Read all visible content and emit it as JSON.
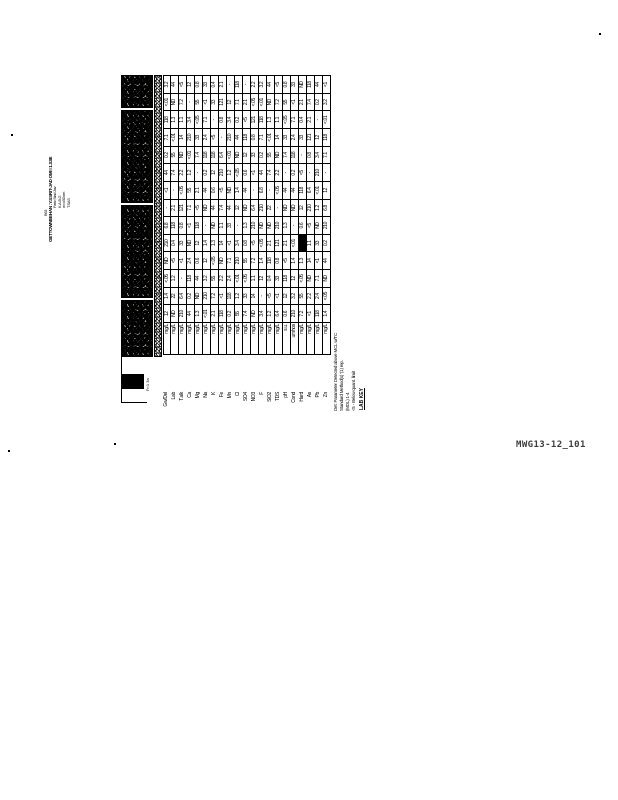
{
  "page": {
    "kind": "scanned-document",
    "figure_label": "MWG13-12_101",
    "ink_color": "#000000",
    "paper_color": "#ffffff"
  },
  "caption": {
    "note": "rotated 90deg caption at left margin; scan-degraded, best-effort transcription",
    "line0": "B63",
    "title": "GETTOWNEEHAN :Y.SSRIT-JAD OMI I 1.S3E",
    "shorts": [
      "Fariv Stad Jav",
      "K.A.B.G",
      "w=o3Dom",
      "T.SAS"
    ]
  },
  "table": {
    "note": "rotated landscape lab-results table; header band is scan-blackened and illegible",
    "header_segments": [
      {
        "x": 68,
        "w": 57
      },
      {
        "x": 127,
        "w": 93
      },
      {
        "x": 222,
        "w": 93
      },
      {
        "x": 317,
        "w": 33
      }
    ],
    "subheader_marks": [
      "3",
      "1",
      "4",
      "1",
      "3",
      "2",
      "4",
      "1",
      "3",
      "4",
      "2",
      "1",
      "3",
      "2"
    ],
    "under_square_text": "Fr:1 3a",
    "rows": [
      {
        "label": "Gw/Del",
        "unit": "mg/L",
        "cells": "12 1.4 <.05 ND 210 6.8 - <1 44 0.2 7.1 118 <.01 3.2"
      },
      {
        "label": "Lab",
        "unit": "mg/L",
        "cells": "ND 22 1.2 <5 0.4 118 2.1 - 7.4 55 <.01 1.3 ND 44"
      },
      {
        "label": "T.alk",
        "unit": "mg/L",
        "cells": "210 6.4 - <1 33 0.8 121 <.05 2.2 ND 14 1.1 7.2 <5"
      },
      {
        "label": "Ca",
        "unit": "mg/L",
        "cells": "44 0.2 118 2.4 ND <1 7.1 55 1.2 <.01 210 3.4 - 12"
      },
      {
        "label": "Mg",
        "unit": "mg/L",
        "cells": "1.3 ND 44 0.6 12 118 <5 2.1 - 7.4 33 <.05 55 0.8"
      },
      {
        "label": "Na",
        "unit": "mg/L",
        "cells": "<.01 210 3.2 12 1.4 - ND 44 0.2 118 2.4 7.1 <1 33"
      },
      {
        "label": "K",
        "unit": "mg/L",
        "cells": "2.1 7.2 55 <.05 1.3 ND 44 0.6 12 118 <5 - 33 0.4"
      },
      {
        "label": "Fe",
        "unit": "mg/L",
        "cells": "118 <1 2.2 ND 14 1.1 7.4 <5 210 6.4 - 0.8 121 2.1"
      },
      {
        "label": "Mn",
        "unit": "mg/L",
        "cells": "0.2 118 2.4 7.1 <1 33 44 ND 1.2 <.01 210 3.4 12 -"
      },
      {
        "label": "Cl",
        "unit": "mg/L",
        "cells": "55 1.2 <.01 210 3.4 - 12 1.4 <.05 ND 44 0.2 7.1 118"
      },
      {
        "label": "SO4",
        "unit": "mg/L",
        "cells": "7.4 33 <.05 55 0.8 1.3 ND 44 0.6 12 118 <5 2.1 -"
      },
      {
        "label": "NO3",
        "unit": "mg/L",
        "cells": "ND 14 1.1 7.2 <5 210 6.4 - <1 33 0.8 121 <.05 2.2"
      },
      {
        "label": "F",
        "unit": "mg/L",
        "cells": "3.4 - 12 1.4 <.05 ND 210 6.8 44 0.2 7.1 118 <.01 3.2"
      },
      {
        "label": "SiO2",
        "unit": "mg/L",
        "cells": "1.2 <5 0.4 118 2.1 ND 22 - 7.4 55 <.01 1.3 ND 44"
      },
      {
        "label": "TDS",
        "unit": "mg/L",
        "cells": "6.4 <1 33 0.8 121 210 - <.05 2.2 ND 14 1.1 7.2 <5"
      },
      {
        "label": "pH",
        "unit": "s.u.",
        "cells": "0.6 12 118 <5 2.1 1.3 ND 44 - 7.4 33 <.05 55 0.8"
      },
      {
        "label": "Cond",
        "unit": "umhos",
        "cells": "210 3.2 12 1.4 <.01 - ND 44 0.2 118 2.4 7.1 <1 33"
      },
      {
        "label": "Hard",
        "unit": "mg/L",
        "cells": "7.2 55 <.05 1.3 DK 0.6 12 118 <5 - 33 0.4 2.1 ND"
      },
      {
        "label": "As",
        "unit": "mg/L",
        "cells": "<1 2.2 ND 14 1.1 <5 210 6.4 - 0.8 121 2.1 7.4 118"
      },
      {
        "label": "Pb",
        "unit": "mg/L",
        "cells": "118 2.4 7.1 <1 33 ND 1.2 <.01 210 3.4 12 - 0.2 44"
      },
      {
        "label": "Zn",
        "unit": "mg/L",
        "cells": "1.4 <.05 ND 44 0.2 210 6.8 12 - 7.1 118 <.01 3.2 <1"
      }
    ],
    "footnotes": [
      "Det: Parameter Detected above MCL w/TC",
      "Standard Method(s) '(1) rep.",
      "(MDL) 1-4",
      "<5 - Below quant. limit"
    ],
    "lab_key_label": "LAB KEY"
  },
  "specks": [
    {
      "x": 11,
      "y": 134
    },
    {
      "x": 8,
      "y": 450
    },
    {
      "x": 599,
      "y": 33
    },
    {
      "x": 114,
      "y": 443
    }
  ]
}
